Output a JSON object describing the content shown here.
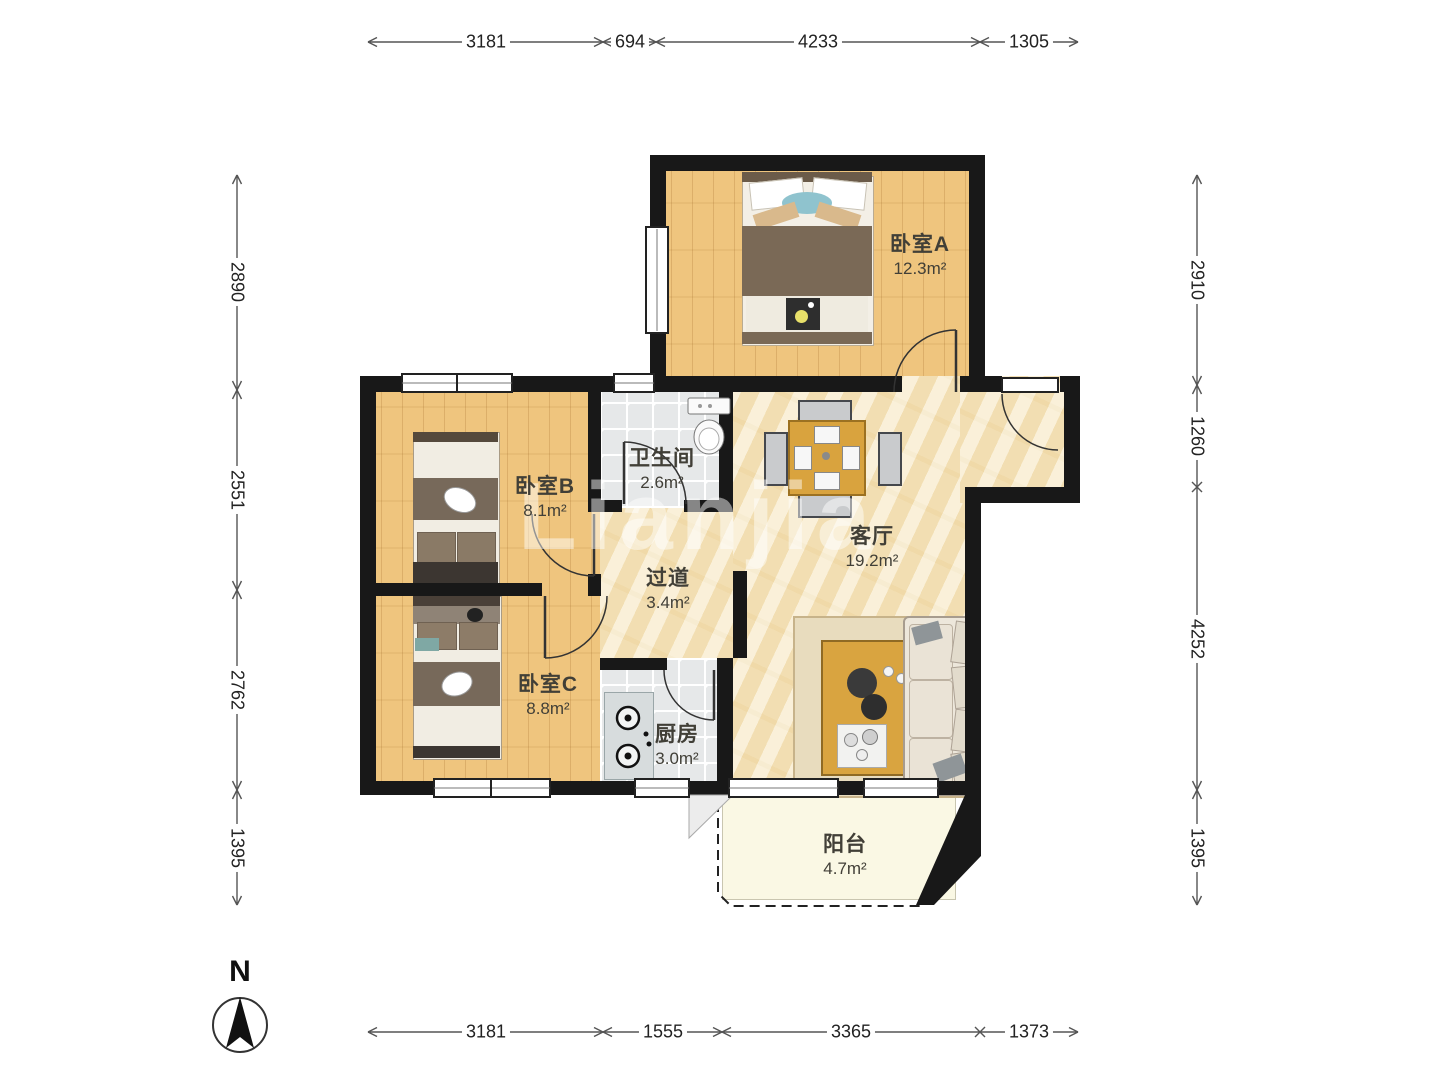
{
  "meta": {
    "watermark": "Lianjia",
    "compass_label": "N"
  },
  "rooms": [
    {
      "name": "卧室A",
      "area": "12.3m²"
    },
    {
      "name": "卧室B",
      "area": "8.1m²"
    },
    {
      "name": "卧室C",
      "area": "8.8m²"
    },
    {
      "name": "卫生间",
      "area": "2.6m²"
    },
    {
      "name": "过道",
      "area": "3.4m²"
    },
    {
      "name": "客厅",
      "area": "19.2m²"
    },
    {
      "name": "厨房",
      "area": "3.0m²"
    },
    {
      "name": "阳台",
      "area": "4.7m²"
    }
  ],
  "dimensions": {
    "top": [
      "3181",
      "694",
      "4233",
      "1305"
    ],
    "bottom": [
      "3181",
      "1555",
      "3365",
      "1373"
    ],
    "left": [
      "2890",
      "2551",
      "2762",
      "1395"
    ],
    "right": [
      "2910",
      "1260",
      "4252",
      "1395"
    ]
  },
  "colors": {
    "wall": "#181818",
    "wood": "#EFC57E",
    "marble": "#F6E6C0",
    "tile": "#E6E8E9",
    "balcony": "#FAF8E4"
  }
}
